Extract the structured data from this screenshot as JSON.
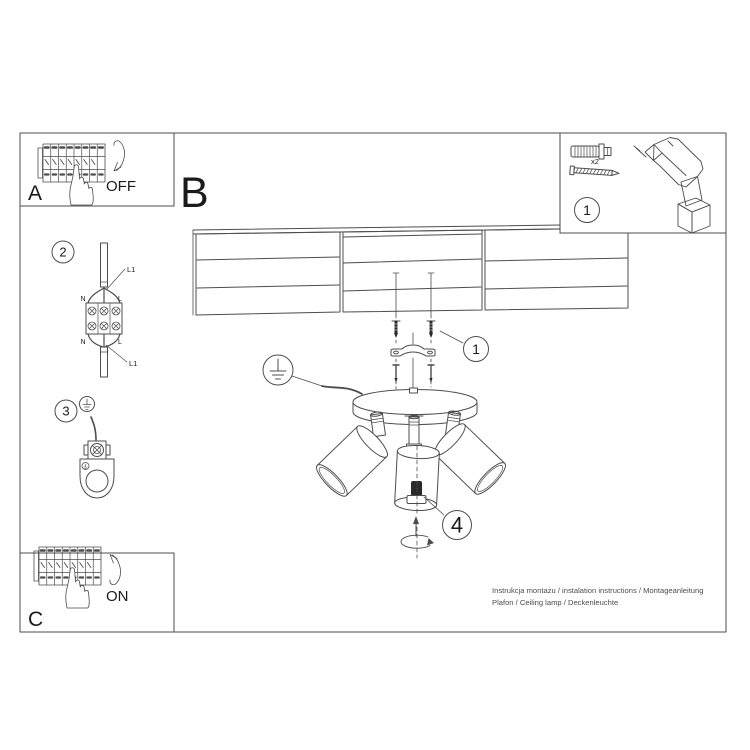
{
  "document": {
    "kind": "ceiling lamp installation instruction sheet",
    "bg_color": "#ffffff",
    "line_color": "#4d4d4d",
    "ink_color": "#1a1a1a"
  },
  "panels": {
    "a": {
      "label": "A",
      "action": "OFF"
    },
    "b": {
      "label": "B"
    },
    "c": {
      "label": "C",
      "action": "ON"
    },
    "tools": {
      "number": "1",
      "quantity": "x2"
    }
  },
  "step2": {
    "number": "2",
    "terminal_labels": {
      "top_left": "N",
      "top_right": "L",
      "bottom_left": "N",
      "bottom_right": "L"
    },
    "wire_labels": {
      "top": "L1",
      "bottom": "L1"
    }
  },
  "step3": {
    "number": "3"
  },
  "assembly": {
    "screws_callout": "1",
    "bulb_callout": "4"
  },
  "footer": {
    "line1": "Instrukcja montażu / instalation instructions / Montageanleitung",
    "line2": "Plafon / Ceiling lamp / Deckenleuchte"
  }
}
